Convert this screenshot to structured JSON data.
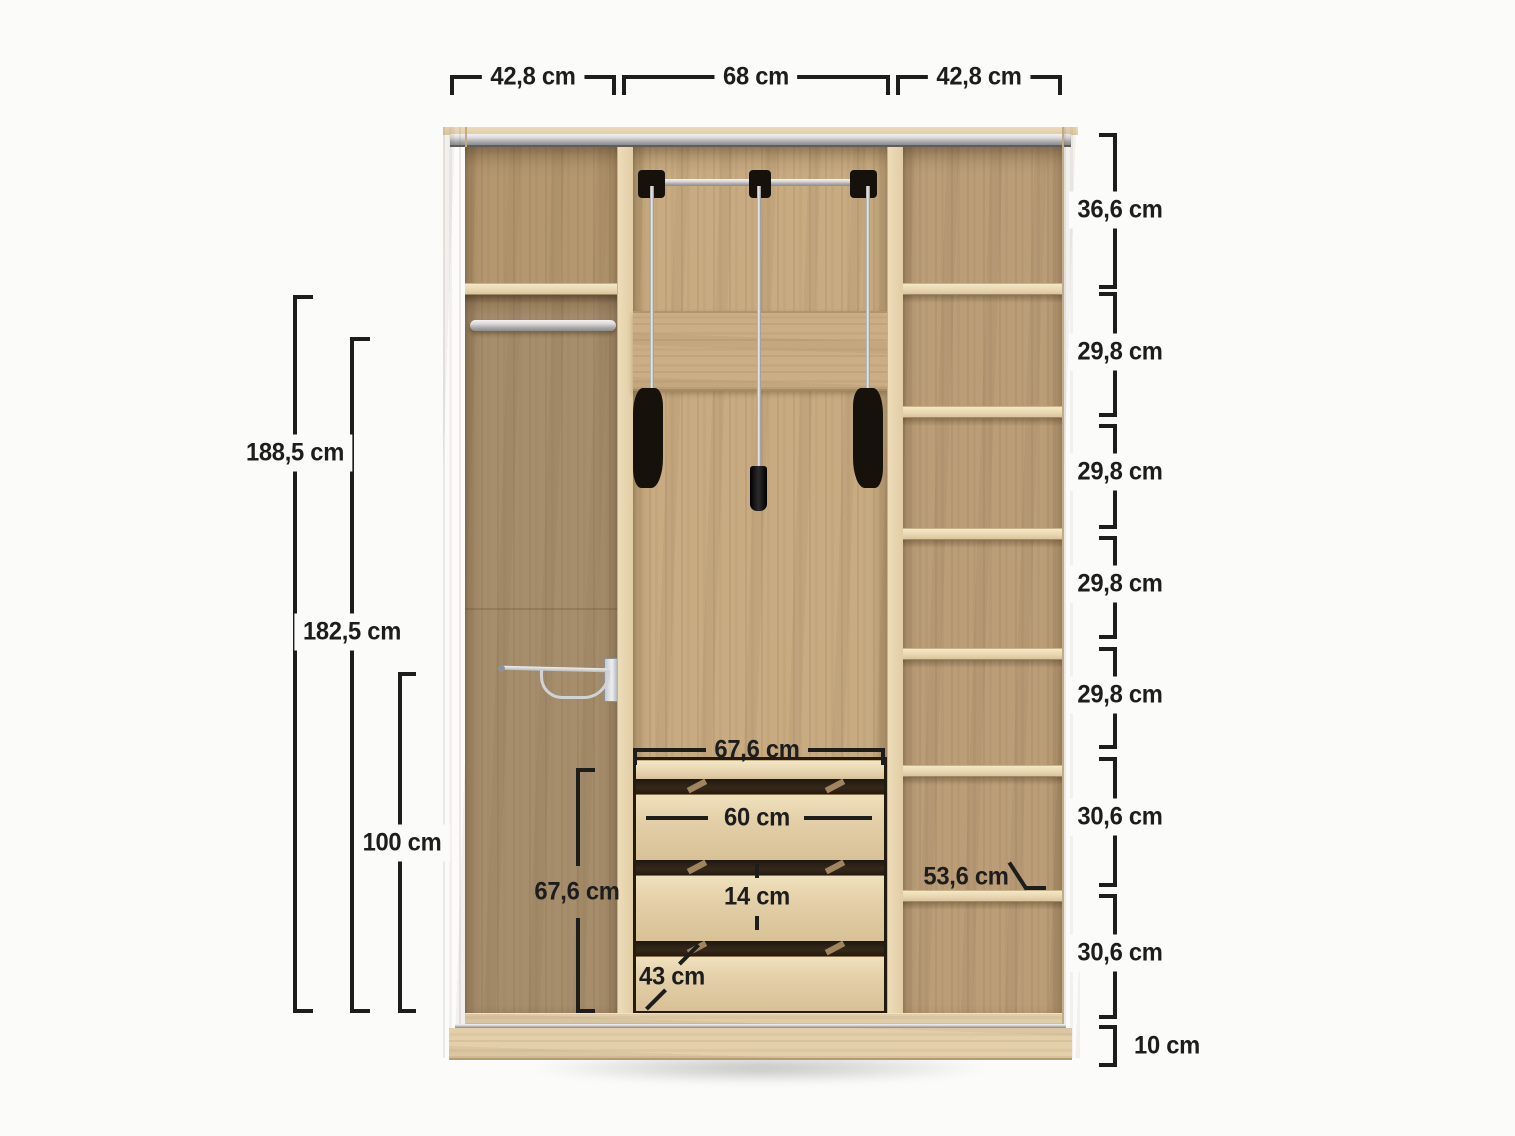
{
  "diagram": {
    "unit": "cm",
    "top_dimensions": [
      {
        "id": "left-section-width",
        "label": "42,8 cm"
      },
      {
        "id": "middle-section-width",
        "label": "68 cm"
      },
      {
        "id": "right-section-width",
        "label": "42,8 cm"
      }
    ],
    "left_dimensions": [
      {
        "id": "overall-height",
        "label": "188,5 cm"
      },
      {
        "id": "interior-height",
        "label": "182,5 cm"
      },
      {
        "id": "lower-section-height",
        "label": "100 cm"
      }
    ],
    "right_dimensions": [
      {
        "id": "compartment-1",
        "label": "36,6 cm"
      },
      {
        "id": "compartment-2",
        "label": "29,8 cm"
      },
      {
        "id": "compartment-3",
        "label": "29,8 cm"
      },
      {
        "id": "compartment-4",
        "label": "29,8 cm"
      },
      {
        "id": "compartment-5",
        "label": "29,8 cm"
      },
      {
        "id": "compartment-6",
        "label": "30,6 cm"
      },
      {
        "id": "compartment-7",
        "label": "30,6 cm"
      },
      {
        "id": "plinth-height",
        "label": "10 cm"
      }
    ],
    "interior_dimensions": {
      "drawer_top_width": "67,6 cm",
      "drawer_front_width": "60 cm",
      "drawer_height": "14 cm",
      "drawer_depth": "43 cm",
      "drawer_unit_height": "67,6 cm",
      "shelf_depth": "53,6 cm"
    },
    "colors": {
      "dimension_line": "#1d1d1d",
      "wood_frame": "#e6d3ae",
      "wood_back_left": "#a68d6b",
      "wood_back_middle": "#c8ab81",
      "wood_back_right": "#bb9e78",
      "hardware_black": "#17110c",
      "hardware_chrome": "#d7d7d7"
    }
  }
}
